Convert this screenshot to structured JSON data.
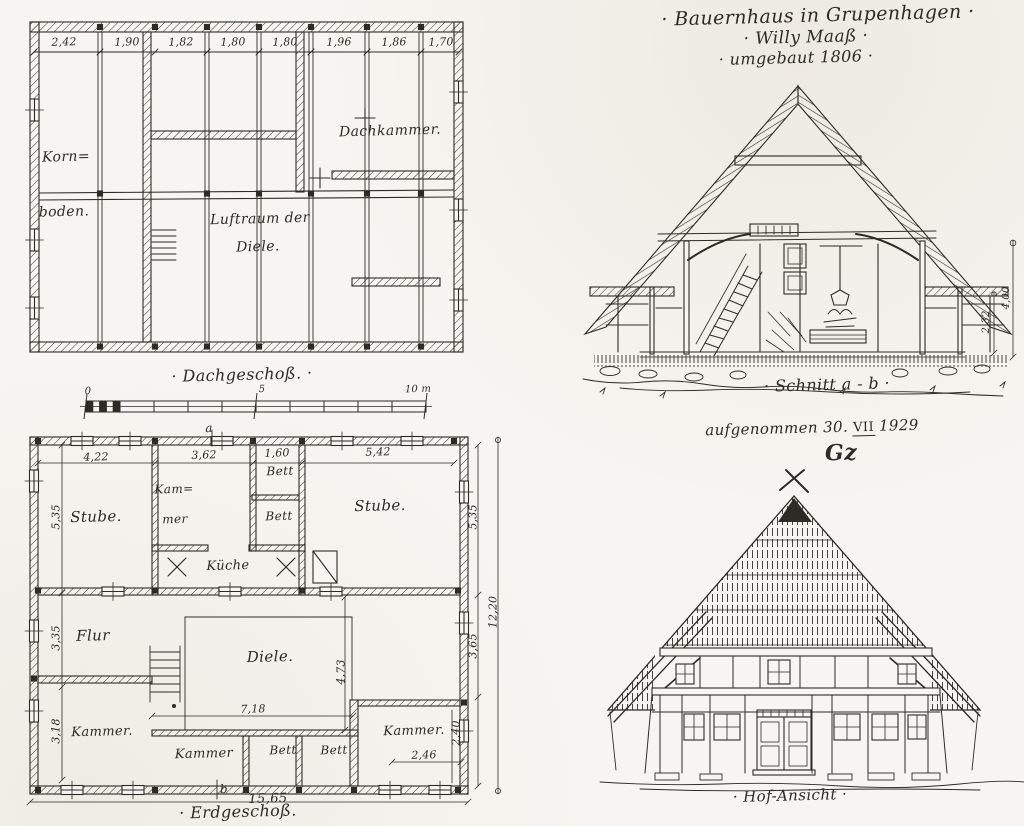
{
  "paper": {
    "background": "#f7f5f1",
    "ink": "#2e2b26"
  },
  "title_block": {
    "line1": "· Bauernhaus in Grupenhagen ·",
    "line2": "· Willy Maaß ·",
    "line3": "· umgebaut 1806 ·"
  },
  "attic_plan": {
    "caption": "· Dachgeschoß. ·",
    "top_dims": [
      "2,42",
      "1,90",
      "1,82",
      "1,80",
      "1,80",
      "1,96",
      "1,86",
      "1,70"
    ],
    "rooms": {
      "kornboden_line1": "Korn=",
      "kornboden_line2": "boden.",
      "dachkammer": "Dachkammer.",
      "luftraum_line1": "Luftraum der",
      "luftraum_line2": "Diele."
    }
  },
  "scale_bar": {
    "zero": "0",
    "five": "5",
    "ten": "10 m"
  },
  "ground_plan": {
    "caption": "· Erdgeschoß.",
    "top_dims": [
      "4,22",
      "3,62",
      "1,60",
      "5,42"
    ],
    "left_dims": [
      "5,35",
      "3,35",
      "3,18"
    ],
    "right_dims": [
      "5,35",
      "3,65",
      "2,40"
    ],
    "overall_height": "12,20",
    "overall_width": "15,65",
    "diele_width": "7,18",
    "diele_height": "4,73",
    "kammer_right_width": "2,46",
    "section_marker_top": "a",
    "section_marker_bottom": "b",
    "rooms": {
      "stube_left": "Stube.",
      "kammer_top_line1": "Kam=",
      "kammer_top_line2": "mer",
      "bett_upper": "Bett",
      "bett_lower": "Bett",
      "stube_right": "Stube.",
      "kueche": "Küche",
      "flur": "Flur",
      "diele": "Diele.",
      "kammer_left": "Kammer.",
      "kammer_bottom": "Kammer",
      "bett_bottom_1": "Bett",
      "bett_bottom_2": "Bett",
      "kammer_right": "Kammer."
    }
  },
  "section_view": {
    "caption": "· Schnitt a - b ·",
    "dim_storey": "2,32",
    "dim_total": "4,00"
  },
  "survey_note": {
    "prefix": "aufgenommen 30.",
    "month_roman": "VII",
    "year": "1929",
    "monogram": "Gz"
  },
  "elevation_view": {
    "caption": "· Hof-Ansicht ·"
  }
}
